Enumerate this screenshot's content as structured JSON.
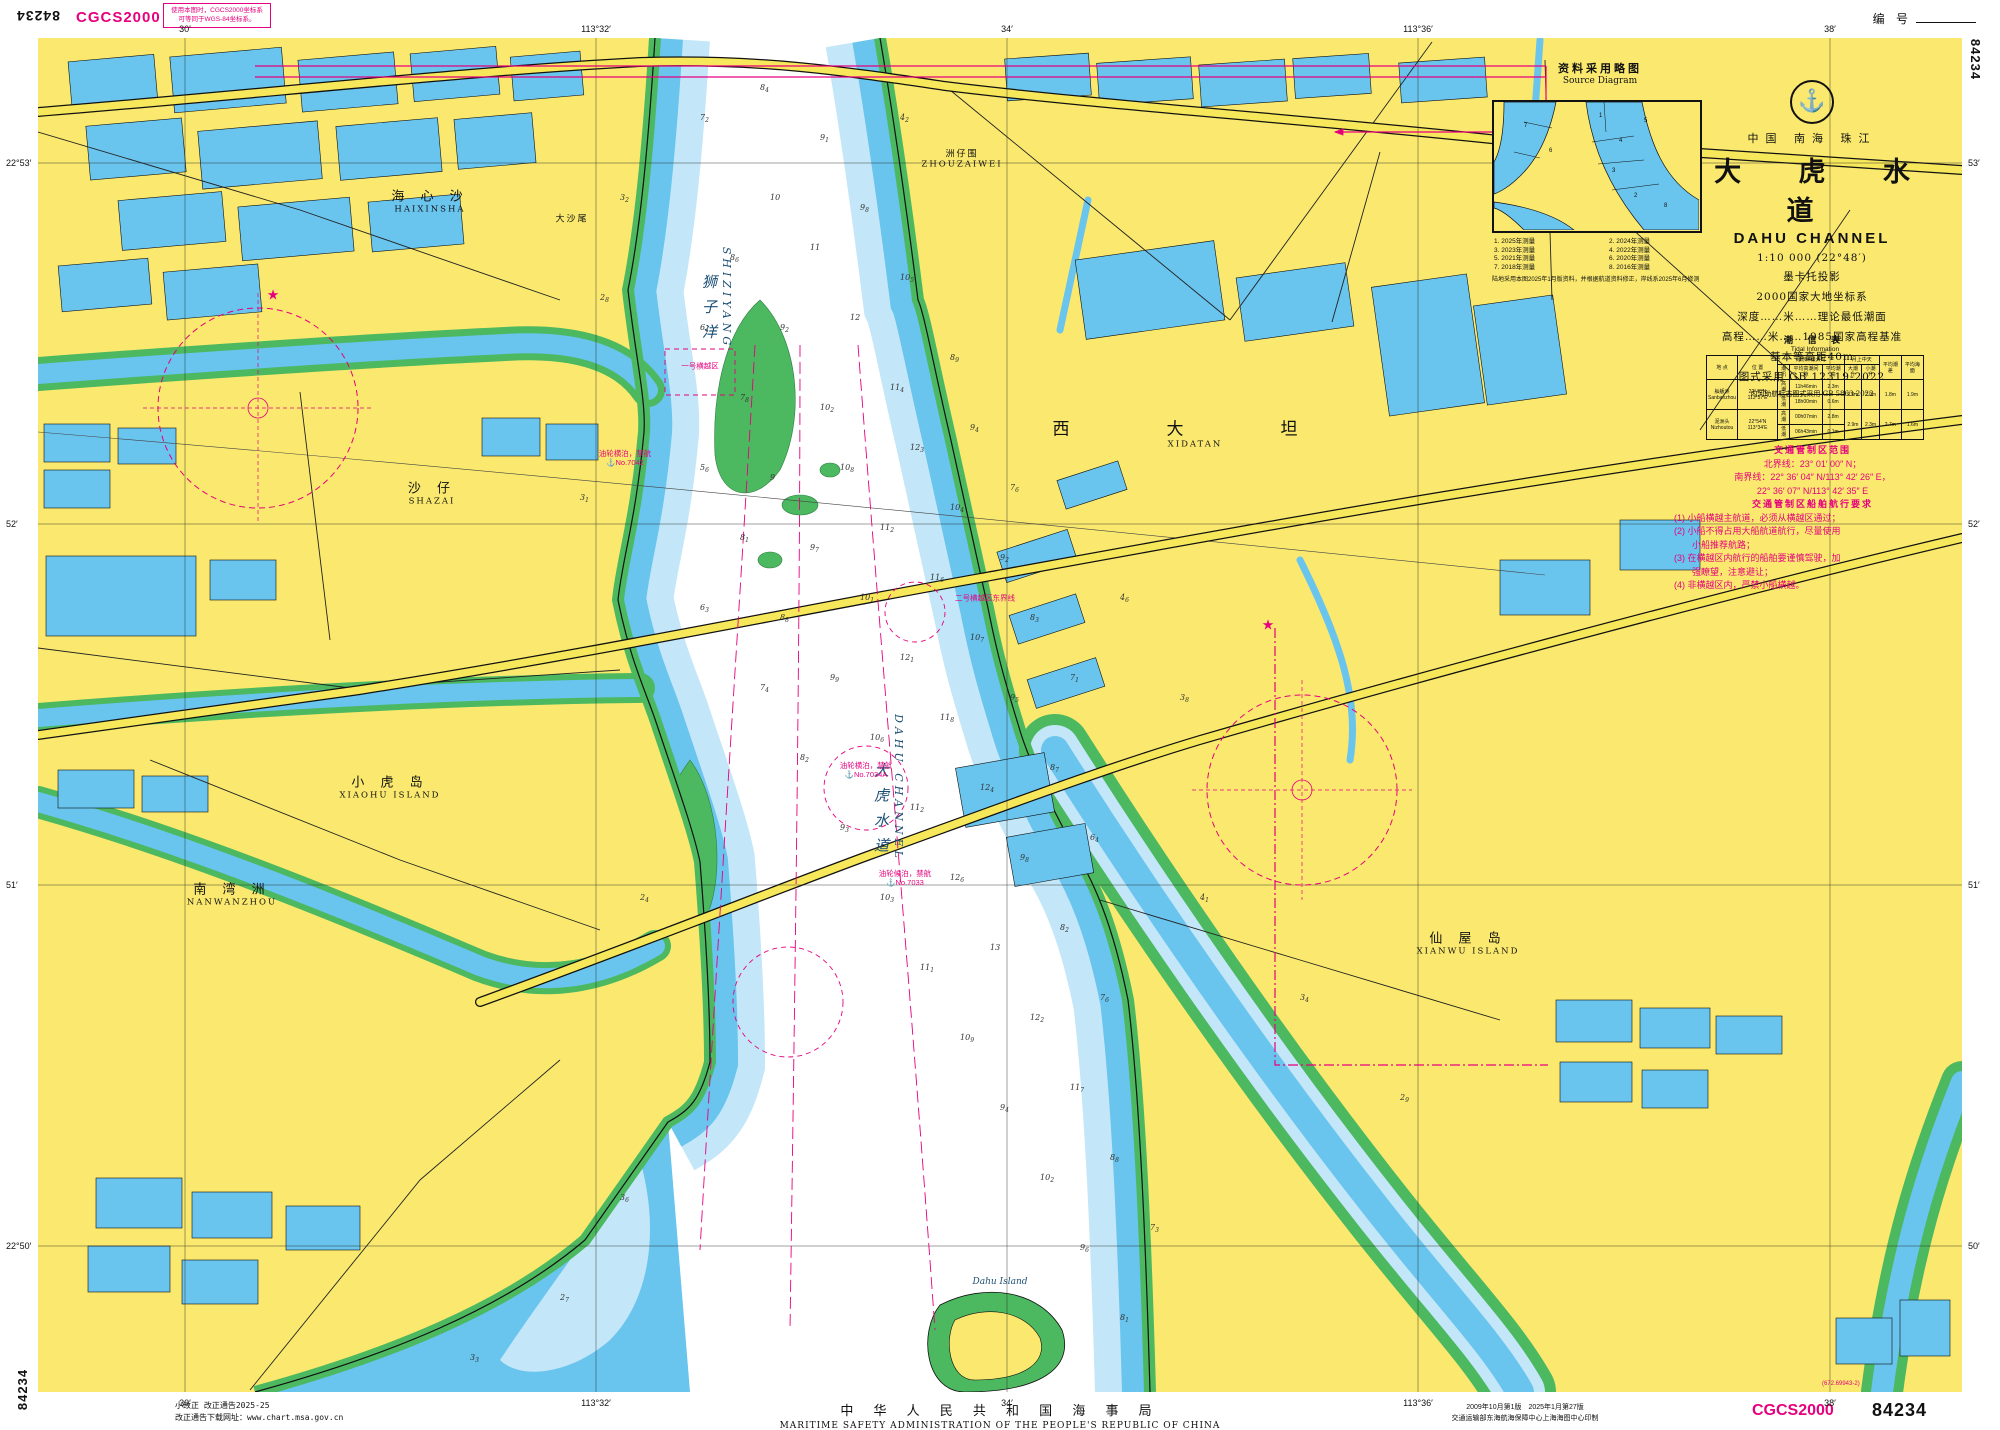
{
  "chart_number": "84234",
  "datum_label": "CGCS2000",
  "datum_note_line1": "使用本图时，CGCS2000坐标系",
  "datum_note_line2": "可等同于WGS-84坐标系。",
  "serial_label": "编 号",
  "title_block": {
    "logo_icon": "anchor",
    "country_line": "中国 南海 珠江",
    "title_cn": "大 虎 水 道",
    "title_en": "DAHU CHANNEL",
    "scale": "1:10 000 (22°48′)",
    "projection": "墨卡托投影",
    "datum": "2000国家大地坐标系",
    "depth_note": "深度……米……理论最低潮面",
    "elevation_note": "高程……米……1985国家高程基准",
    "contour_note": "基本等高距40m",
    "symbols_note": "图式采用 GB 12319-2022",
    "inland_note": "内河助航标志图式采用 GB 5863-2022"
  },
  "source_diagram": {
    "title_cn": "资料采用略图",
    "title_en": "Source Diagram",
    "numbers": [
      "1",
      "7",
      "5",
      "4",
      "3",
      "2",
      "8",
      "6"
    ],
    "legend": [
      "1. 2025年测量",
      "2. 2024年测量",
      "3. 2023年测量",
      "4. 2022年测量",
      "5. 2021年测量",
      "6. 2020年测量",
      "7. 2018年测量",
      "8. 2016年测量"
    ],
    "note": "陆地采用本图2025年1月版资料，并根据航道资料修正，岸线系2025年6月修测"
  },
  "tide_table": {
    "title_cn": "潮 信 表",
    "title_en": "Tidal Information",
    "headers": {
      "place": "地 点",
      "pos": "位 置",
      "group1": "月赤纬最大时",
      "tide": "潮汛",
      "interval": "平均高潮间隙",
      "height": "平均潮高",
      "group2": "月上中天",
      "spring": "大潮升",
      "neap": "小潮升",
      "range": "平均潮差",
      "msl": "平均海面"
    },
    "rows": [
      {
        "place_cn": "舢舨洲",
        "place_en": "Sanbanzhou",
        "pos": "22°48′N 113°37′E",
        "tides": [
          {
            "name": "高潮",
            "time": "11h46min",
            "height": "2.3m"
          },
          {
            "name": "低潮",
            "time": "18h00min",
            "height": "0.6m"
          }
        ],
        "spring": "2.6m",
        "neap": "2.0m",
        "range": "1.8m",
        "msl": "1.9m"
      },
      {
        "place_cn": "泥洲头",
        "place_en": "Nizhoutou",
        "pos": "22°54′N 113°34′E",
        "tides": [
          {
            "name": "高潮",
            "time": "00h07min",
            "height": "2.8m"
          },
          {
            "name": "低潮",
            "time": "06h43min",
            "height": "0.1m"
          }
        ],
        "spring": "2.9m",
        "neap": "2.3m",
        "range": "2.7m",
        "msl": "1.6m"
      }
    ]
  },
  "traffic_note": {
    "header1": "交通管制区范围",
    "bounds": [
      "北界线：23° 01′ 00″ N；",
      "南界线：22° 36′ 04″ N/113° 42′ 26″ E，",
      "22° 36′ 07″ N/113° 42′ 35″ E"
    ],
    "header2": "交通管制区船舶航行要求",
    "rules": [
      "(1) 小船横越主航道，必须从横越区通过；",
      "(2) 小船不得占用大船航道航行，尽量使用",
      "　　小船推荐航路；",
      "(3) 在横越区内航行的船舶要谨慎驾驶，加",
      "　　强瞭望，注意避让；",
      "(4) 非横越区内，严禁小船横越。"
    ]
  },
  "graticule": {
    "lon": [
      {
        "x": 185,
        "label": "30′"
      },
      {
        "x": 596,
        "label": "113°32′"
      },
      {
        "x": 1007,
        "label": "34′"
      },
      {
        "x": 1418,
        "label": "113°36′"
      },
      {
        "x": 1830,
        "label": "38′"
      }
    ],
    "lat": [
      {
        "y": 163,
        "left": "22°53′",
        "right": "53′"
      },
      {
        "y": 524,
        "left": "52′",
        "right": "52′"
      },
      {
        "y": 885,
        "left": "51′",
        "right": "51′"
      },
      {
        "y": 1246,
        "left": "22°50′",
        "right": "50′"
      }
    ]
  },
  "map": {
    "places": [
      {
        "cn": "海 心 沙",
        "en": "HAIXINSHA",
        "x": 430,
        "y": 200,
        "cls": ""
      },
      {
        "cn": "洲仔围",
        "en": "ZHOUZAIWEI",
        "x": 962,
        "y": 158,
        "cls": "small"
      },
      {
        "cn": "西　大　坦",
        "en": "XIDATAN",
        "x": 1195,
        "y": 432,
        "cls": "big"
      },
      {
        "cn": "沙 仔",
        "en": "SHAZAI",
        "x": 432,
        "y": 492,
        "cls": ""
      },
      {
        "cn": "小 虎 岛",
        "en": "XIAOHU ISLAND",
        "x": 390,
        "y": 786,
        "cls": ""
      },
      {
        "cn": "南 湾 洲",
        "en": "NANWANZHOU",
        "x": 232,
        "y": 893,
        "cls": ""
      },
      {
        "cn": "仙 屋 岛",
        "en": "XIANWU ISLAND",
        "x": 1468,
        "y": 942,
        "cls": ""
      },
      {
        "cn": "大沙尾",
        "en": "",
        "x": 572,
        "y": 218,
        "cls": "small"
      }
    ],
    "water_labels": [
      {
        "cn": "狮子洋",
        "en": "SHIZIYANG",
        "x": 716,
        "y": 300,
        "vertical": true
      },
      {
        "cn": "大虎水道",
        "en": "DAHU CHANNEL",
        "x": 888,
        "y": 790,
        "vertical": true
      },
      {
        "cn": "",
        "en": "Dahu Island",
        "x": 1000,
        "y": 1282,
        "vertical": false
      }
    ],
    "annotations": [
      {
        "t": "一号横越区",
        "t2": "",
        "x": 700,
        "y": 366
      },
      {
        "t": "二号横越区东界线",
        "t2": "",
        "x": 985,
        "y": 598
      },
      {
        "t": "油轮横泊，禁航",
        "t2": "⚓No.7042",
        "x": 625,
        "y": 458
      },
      {
        "t": "油轮横泊，禁航",
        "t2": "⚓No.7034A",
        "x": 866,
        "y": 770
      },
      {
        "t": "油轮候泊，禁航",
        "t2": "⚓No.7033",
        "x": 905,
        "y": 878
      }
    ],
    "stars": [
      {
        "x": 273,
        "y": 295
      },
      {
        "x": 1268,
        "y": 625
      }
    ],
    "soundings": [
      [
        700,
        120,
        "7",
        "2"
      ],
      [
        760,
        90,
        "8",
        "4"
      ],
      [
        820,
        140,
        "9",
        "1"
      ],
      [
        770,
        200,
        "10",
        ""
      ],
      [
        730,
        260,
        "8",
        "6"
      ],
      [
        810,
        250,
        "11",
        ""
      ],
      [
        860,
        210,
        "9",
        "8"
      ],
      [
        700,
        330,
        "6",
        "4"
      ],
      [
        780,
        330,
        "9",
        "2"
      ],
      [
        850,
        320,
        "12",
        ""
      ],
      [
        900,
        280,
        "10",
        "5"
      ],
      [
        740,
        400,
        "7",
        "8"
      ],
      [
        820,
        410,
        "10",
        "2"
      ],
      [
        890,
        390,
        "11",
        "4"
      ],
      [
        950,
        360,
        "8",
        "9"
      ],
      [
        700,
        470,
        "5",
        "6"
      ],
      [
        770,
        480,
        "9",
        ""
      ],
      [
        840,
        470,
        "10",
        "8"
      ],
      [
        910,
        450,
        "12",
        "3"
      ],
      [
        970,
        430,
        "9",
        "4"
      ],
      [
        740,
        540,
        "8",
        "1"
      ],
      [
        810,
        550,
        "9",
        "7"
      ],
      [
        880,
        530,
        "11",
        "2"
      ],
      [
        950,
        510,
        "10",
        "4"
      ],
      [
        1010,
        490,
        "7",
        "6"
      ],
      [
        700,
        610,
        "6",
        "3"
      ],
      [
        780,
        620,
        "8",
        "8"
      ],
      [
        860,
        600,
        "10",
        "1"
      ],
      [
        930,
        580,
        "11",
        "6"
      ],
      [
        1000,
        560,
        "9",
        "2"
      ],
      [
        760,
        690,
        "7",
        "4"
      ],
      [
        830,
        680,
        "9",
        "9"
      ],
      [
        900,
        660,
        "12",
        "1"
      ],
      [
        970,
        640,
        "10",
        "7"
      ],
      [
        1030,
        620,
        "8",
        "3"
      ],
      [
        800,
        760,
        "8",
        "2"
      ],
      [
        870,
        740,
        "10",
        "6"
      ],
      [
        940,
        720,
        "11",
        "8"
      ],
      [
        1010,
        700,
        "9",
        "5"
      ],
      [
        1070,
        680,
        "7",
        "1"
      ],
      [
        840,
        830,
        "9",
        "3"
      ],
      [
        910,
        810,
        "11",
        "2"
      ],
      [
        980,
        790,
        "12",
        "4"
      ],
      [
        1050,
        770,
        "8",
        "7"
      ],
      [
        880,
        900,
        "10",
        "3"
      ],
      [
        950,
        880,
        "12",
        "6"
      ],
      [
        1020,
        860,
        "9",
        "8"
      ],
      [
        1090,
        840,
        "6",
        "4"
      ],
      [
        920,
        970,
        "11",
        "1"
      ],
      [
        990,
        950,
        "13",
        ""
      ],
      [
        1060,
        930,
        "8",
        "2"
      ],
      [
        960,
        1040,
        "10",
        "9"
      ],
      [
        1030,
        1020,
        "12",
        "2"
      ],
      [
        1100,
        1000,
        "7",
        "6"
      ],
      [
        1000,
        1110,
        "9",
        "4"
      ],
      [
        1070,
        1090,
        "11",
        "7"
      ],
      [
        1040,
        1180,
        "10",
        "2"
      ],
      [
        1110,
        1160,
        "8",
        "8"
      ],
      [
        1080,
        1250,
        "9",
        "6"
      ],
      [
        1150,
        1230,
        "7",
        "3"
      ],
      [
        1120,
        1320,
        "8",
        "1"
      ],
      [
        620,
        200,
        "3",
        "2"
      ],
      [
        600,
        300,
        "2",
        "8"
      ],
      [
        580,
        500,
        "3",
        "1"
      ],
      [
        640,
        900,
        "2",
        "4"
      ],
      [
        900,
        120,
        "4",
        "2"
      ],
      [
        1120,
        600,
        "4",
        "6"
      ],
      [
        1180,
        700,
        "3",
        "8"
      ],
      [
        1200,
        900,
        "4",
        "1"
      ],
      [
        1300,
        1000,
        "3",
        "4"
      ],
      [
        1400,
        1100,
        "2",
        "9"
      ],
      [
        620,
        1200,
        "3",
        "6"
      ],
      [
        560,
        1300,
        "2",
        "7"
      ],
      [
        470,
        1360,
        "3",
        "3"
      ]
    ]
  },
  "footer": {
    "correction1": "小改正 改正通告2025-25",
    "correction2": "改正通告下载网址：www.chart.msa.gov.cn",
    "msa_cn": "中 华 人 民 共 和 国 海 事 局",
    "msa_en": "MARITIME SAFETY ADMINISTRATION OF THE PEOPLE'S REPUBLIC OF CHINA",
    "edition_line": "2009年10月第1版　2025年1月第27版",
    "printer_line": "交通运输部东海航海保障中心上海海图中心印制",
    "print_code": "(672.69943-2)"
  }
}
